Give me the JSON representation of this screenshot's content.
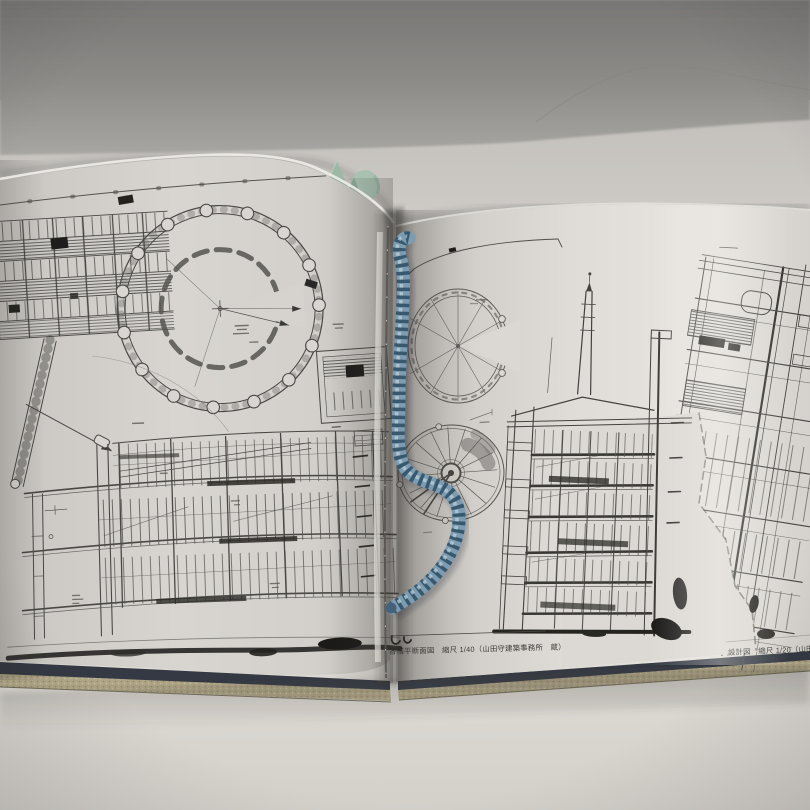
{
  "scene": {
    "type": "photograph of an open book of architectural drawings lying on a table",
    "wall_color": "#85837f",
    "table_color": "#e2dfd9",
    "crack": "hairline-crack-top-right"
  },
  "book": {
    "page_color": "#d9d6d1",
    "cover_edge_color": "#343943",
    "text_block_edge_color": "#b0a687",
    "left_page": {
      "drawings": [
        {
          "name": "facade-elevation-grid"
        },
        {
          "name": "large-circular-plan"
        },
        {
          "name": "ramp-and-leader-lines"
        },
        {
          "name": "detail-plan-inset"
        },
        {
          "name": "long-building-section"
        }
      ]
    },
    "right_page": {
      "drawings": [
        {
          "name": "c-shaped-ring-plan"
        },
        {
          "name": "radial-spoke-plan"
        },
        {
          "name": "tower-cross-section"
        },
        {
          "name": "tilted-facade-elevation"
        }
      ],
      "captions": [
        {
          "text": "各階平断面図　縮尺 1/40（山田守建築事務所　蔵）",
          "scale": "1/40"
        },
        {
          "text": "設計図　縮尺 1/20（山田守建",
          "scale": "1/20"
        }
      ]
    }
  },
  "objects": {
    "bookmark_cord": {
      "kind": "coiled elastic bookmark cord",
      "color": "#7d9cb2",
      "stripe_color": "#38586e"
    },
    "page_flag": {
      "kind": "mint green sticky flag",
      "color": "#a8c1b1"
    }
  },
  "ink": {
    "line_color": "#44423f",
    "smudge_color": "#1d1b19"
  }
}
